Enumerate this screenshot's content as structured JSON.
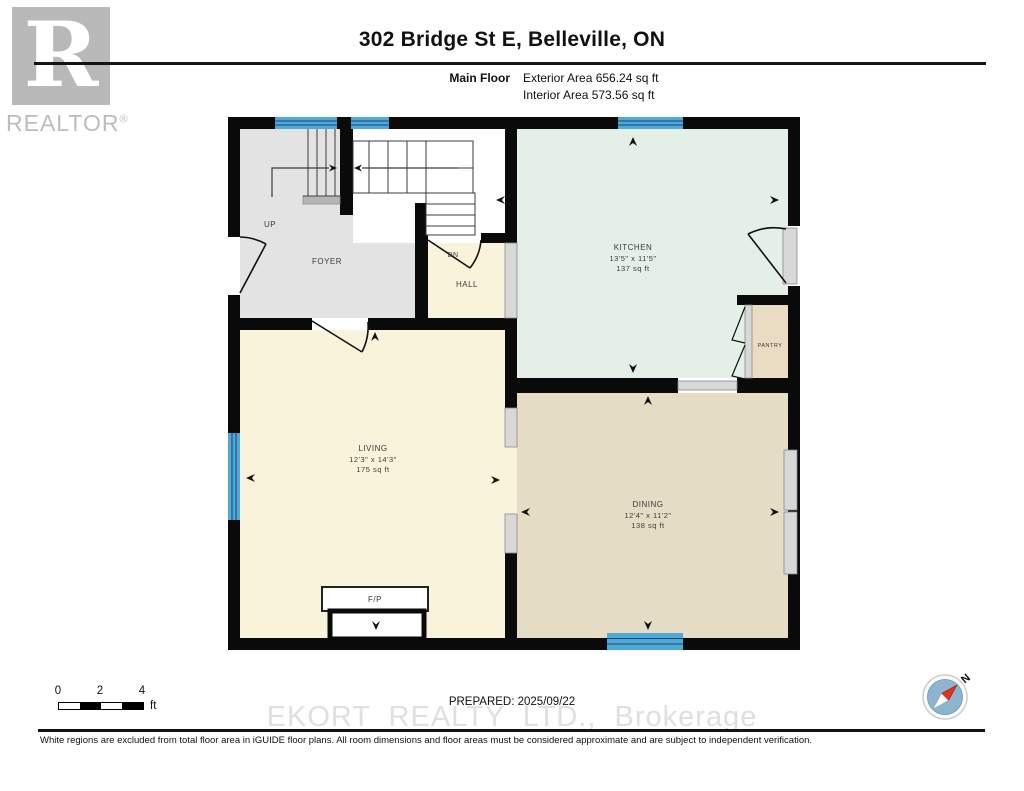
{
  "logo": {
    "letter": "R",
    "wordmark": "REALTOR",
    "registered": "®"
  },
  "header": {
    "title": "302 Bridge St E, Belleville, ON",
    "floor_label": "Main Floor",
    "exterior_area": "Exterior Area 656.24 sq ft",
    "interior_area": "Interior Area 573.56 sq ft"
  },
  "plan": {
    "rooms": {
      "foyer": {
        "name": "FOYER"
      },
      "hall": {
        "name": "HALL"
      },
      "kitchen": {
        "name": "KITCHEN",
        "dims": "13'5\" x 11'5\"",
        "area": "137 sq ft"
      },
      "pantry": {
        "name": "PANTRY"
      },
      "living": {
        "name": "LIVING",
        "dims": "12'3\" x 14'3\"",
        "area": "175 sq ft"
      },
      "dining": {
        "name": "DINING",
        "dims": "12'4\" x 11'2\"",
        "area": "138 sq ft"
      },
      "fireplace": {
        "name": "F/P"
      }
    },
    "stairs": {
      "up": "UP",
      "down": "DN"
    }
  },
  "footer": {
    "scale_bar": {
      "ticks": [
        "0",
        "2",
        "4"
      ],
      "unit": "ft"
    },
    "prepared": "PREPARED: 2025/09/22",
    "watermark": "EKORT REALTY LTD., Brokerage",
    "disclaimer": "White regions are excluded from total floor area in iGUIDE floor plans. All room dimensions and floor areas must be considered approximate and are subject to independent verification.",
    "compass": {
      "north_label": "N"
    }
  },
  "colors": {
    "wall": "#0a0a0a",
    "window_blue": "#4fa8d8",
    "room_gray": "#e3e3e3",
    "room_cream": "#faf3dc",
    "room_mint": "#e4efe8",
    "room_tan": "#e5dcc6",
    "door_gray": "#d8d8d8",
    "watermark_gray": "#e0e0e0",
    "logo_gray": "#b9b9b9",
    "compass_red": "#e03020"
  }
}
